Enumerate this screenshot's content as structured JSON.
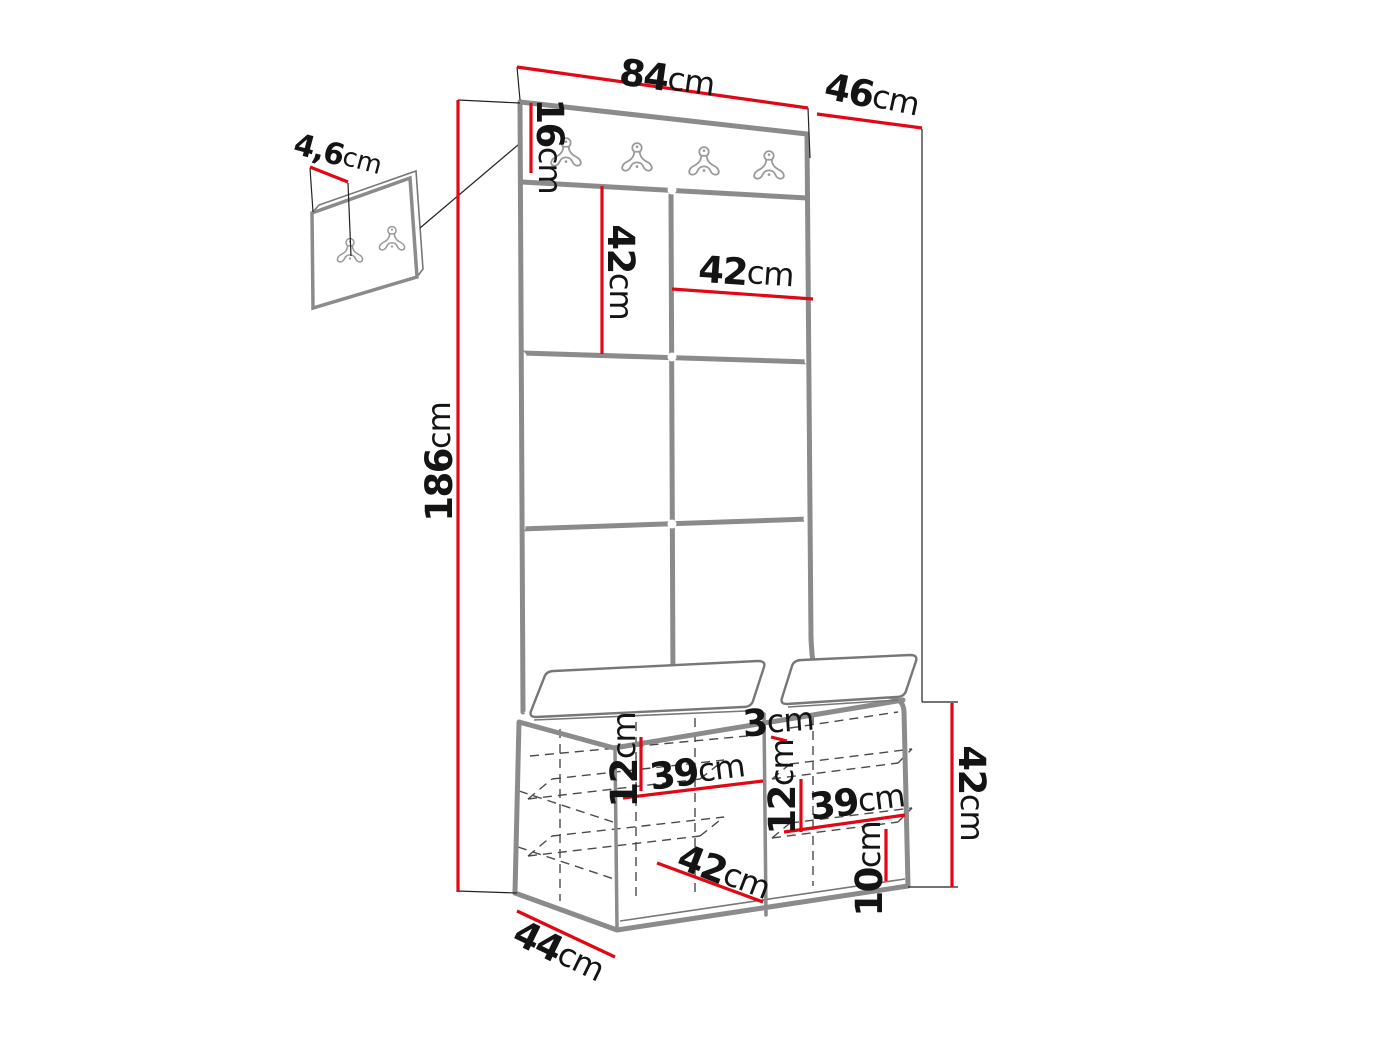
{
  "diagram": {
    "type": "furniture-dimension-drawing",
    "subject": "hallway set: wall hook panel with padded tiles and storage bench, plus small two-hook wall panel",
    "colors": {
      "dimension_red": "#e30613",
      "outline_gray": "#8b8b8b",
      "hidden_line_gray": "#4a4a4a",
      "label_black": "#141414",
      "background": "#ffffff"
    },
    "hooks": {
      "main_rail_count": 4,
      "small_panel_count": 2
    },
    "labels": {
      "panel_width": {
        "value": "84",
        "unit": "cm"
      },
      "side_depth": {
        "value": "46",
        "unit": "cm"
      },
      "rail_height": {
        "value": "16",
        "unit": "cm"
      },
      "small_panel_offset": {
        "value": "4,6",
        "unit": "cm"
      },
      "total_height": {
        "value": "186",
        "unit": "cm"
      },
      "tile_height": {
        "value": "42",
        "unit": "cm"
      },
      "tile_width": {
        "value": "42",
        "unit": "cm"
      },
      "cushion_gap": {
        "value": "3",
        "unit": "cm"
      },
      "bench_height": {
        "value": "42",
        "unit": "cm"
      },
      "left_inner_height": {
        "value": "12",
        "unit": "cm"
      },
      "left_inner_width": {
        "value": "39",
        "unit": "cm"
      },
      "right_inner_height": {
        "value": "12",
        "unit": "cm"
      },
      "right_inner_width": {
        "value": "39",
        "unit": "cm"
      },
      "plinth_height": {
        "value": "10",
        "unit": "cm"
      },
      "bottom_width": {
        "value": "42",
        "unit": "cm"
      },
      "bench_depth": {
        "value": "44",
        "unit": "cm"
      }
    }
  }
}
